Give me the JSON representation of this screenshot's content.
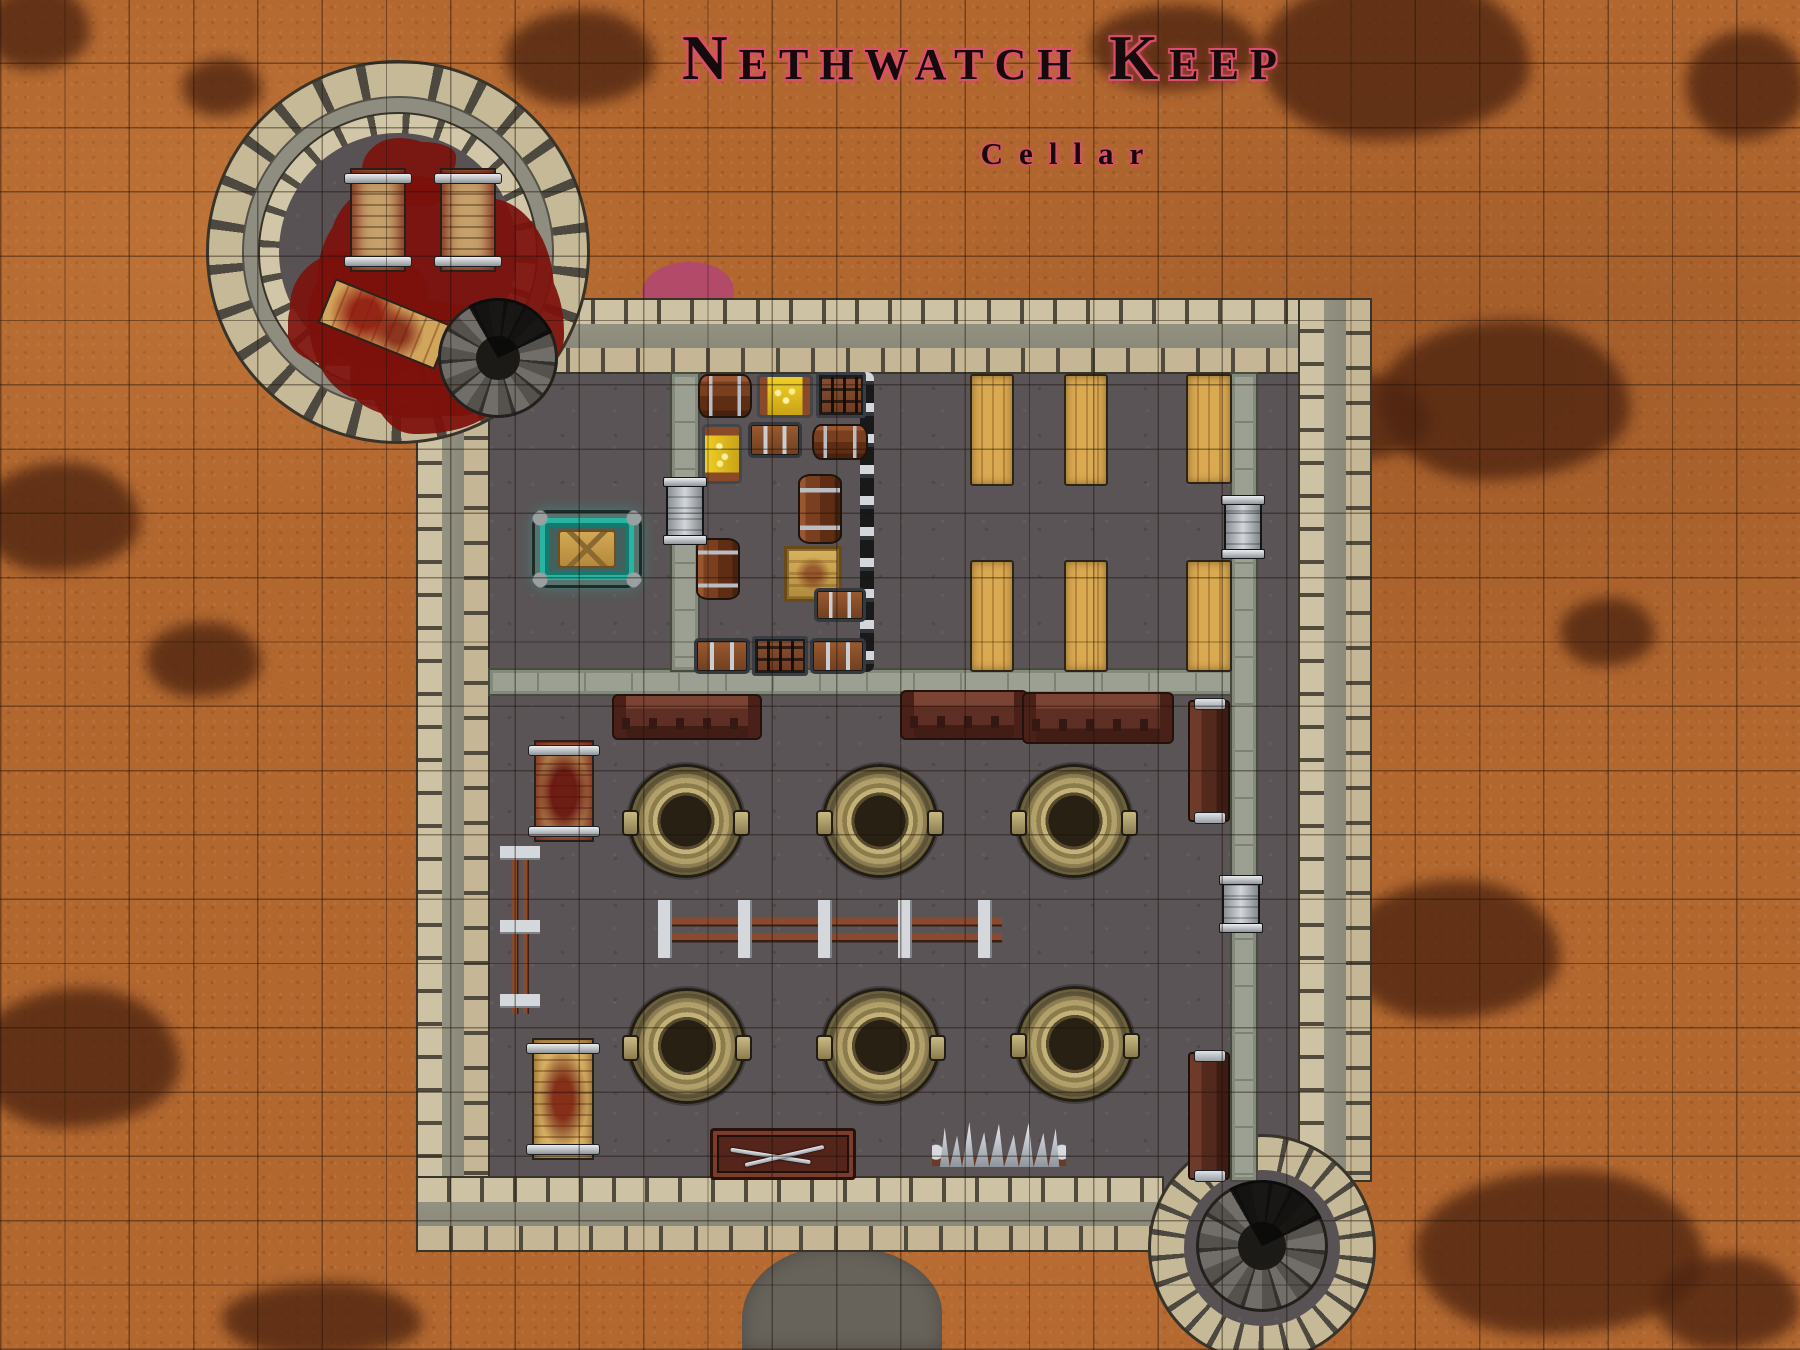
{
  "title": {
    "text": "Nethwatch Keep",
    "subtitle": "Cellar"
  },
  "colors": {
    "title_fill": "#150a0c",
    "title_glow": "#d94f66",
    "terrain": "#b2672f",
    "terrain_stain": "#4e2410",
    "floor": "#5a5456",
    "wall_stone": "#cec2a4",
    "wall_core": "#8f8d82",
    "blood": "#7d110c",
    "cauldron_brass": "#b3a26c",
    "gold": "#eecf2a",
    "ritual_teal": "#29b3a2",
    "table_wood": "#c89449",
    "bench_wood": "#5f2f24",
    "pink_marker": "#b4486e"
  },
  "grid": {
    "cell_px": 64.3
  },
  "map": {
    "objects": [
      {
        "n": "terrain-stain",
        "t": "stain",
        "x": 1090,
        "y": 5,
        "w": 170,
        "h": 85
      },
      {
        "n": "terrain-stain",
        "t": "stain",
        "x": 1260,
        "y": -25,
        "w": 270,
        "h": 165
      },
      {
        "n": "terrain-stain",
        "t": "stain",
        "x": 1686,
        "y": 30,
        "w": 120,
        "h": 110
      },
      {
        "n": "terrain-stain",
        "t": "stain",
        "x": 1380,
        "y": 320,
        "w": 250,
        "h": 160
      },
      {
        "n": "terrain-stain",
        "t": "stain",
        "x": 1290,
        "y": 375,
        "w": 140,
        "h": 85
      },
      {
        "n": "terrain-stain",
        "t": "stain",
        "x": 1560,
        "y": 598,
        "w": 95,
        "h": 68
      },
      {
        "n": "terrain-stain",
        "t": "stain",
        "x": 1345,
        "y": 880,
        "w": 215,
        "h": 140
      },
      {
        "n": "terrain-stain",
        "t": "stain",
        "x": 1415,
        "y": 1170,
        "w": 290,
        "h": 165
      },
      {
        "n": "terrain-stain",
        "t": "stain",
        "x": 1655,
        "y": 1255,
        "w": 145,
        "h": 95
      },
      {
        "n": "terrain-stain",
        "t": "stain",
        "x": -15,
        "y": -15,
        "w": 105,
        "h": 85
      },
      {
        "n": "terrain-stain",
        "t": "stain",
        "x": 182,
        "y": 58,
        "w": 80,
        "h": 58
      },
      {
        "n": "terrain-stain",
        "t": "stain",
        "x": -20,
        "y": 462,
        "w": 160,
        "h": 110
      },
      {
        "n": "terrain-stain",
        "t": "stain",
        "x": 146,
        "y": 622,
        "w": 115,
        "h": 75
      },
      {
        "n": "terrain-stain",
        "t": "stain",
        "x": -25,
        "y": 988,
        "w": 205,
        "h": 140
      },
      {
        "n": "terrain-stain",
        "t": "stain",
        "x": 222,
        "y": 1282,
        "w": 200,
        "h": 75
      },
      {
        "n": "terrain-stain",
        "t": "stain",
        "x": 505,
        "y": 10,
        "w": 150,
        "h": 95
      },
      {
        "n": "stone-path",
        "t": "grey-patch",
        "x": 742,
        "y": 1246,
        "w": 200,
        "h": 104
      },
      {
        "n": "pink-marker",
        "t": "pink-blob",
        "x": 642,
        "y": 262,
        "w": 92,
        "h": 52
      },
      {
        "n": "keep-floor",
        "t": "floor-keep",
        "x": 430,
        "y": 318,
        "w": 902,
        "h": 904
      },
      {
        "n": "wall-north",
        "t": "wall-h",
        "x": 428,
        "y": 298,
        "w": 934,
        "h": 76
      },
      {
        "n": "wall-west",
        "t": "wall-v",
        "x": 416,
        "y": 298,
        "w": 74,
        "h": 954
      },
      {
        "n": "wall-east",
        "t": "wall-v",
        "x": 1298,
        "y": 298,
        "w": 74,
        "h": 884
      },
      {
        "n": "wall-south",
        "t": "wall-h",
        "x": 416,
        "y": 1176,
        "w": 748,
        "h": 76
      },
      {
        "n": "stair-alcove-wall",
        "t": "disc-stone",
        "x": 1148,
        "y": 1134,
        "w": 228,
        "h": 228
      },
      {
        "n": "stair-alcove-floor",
        "t": "disc-floor",
        "x": 1184,
        "y": 1170,
        "w": 156,
        "h": 156
      },
      {
        "n": "tower-wall-outer",
        "t": "disc-stone",
        "x": 206,
        "y": 60,
        "w": 384,
        "h": 384
      },
      {
        "n": "tower-wall-band",
        "t": "disc-grey",
        "x": 242,
        "y": 96,
        "w": 312,
        "h": 312
      },
      {
        "n": "tower-wall-inner",
        "t": "disc-stone2",
        "x": 258,
        "y": 112,
        "w": 280,
        "h": 280
      },
      {
        "n": "tower-floor",
        "t": "disc-floor",
        "x": 279,
        "y": 133,
        "w": 238,
        "h": 238
      },
      {
        "n": "wall-divider",
        "t": "wall-thin-h",
        "x": 488,
        "y": 668,
        "w": 770,
        "h": 28
      },
      {
        "n": "wall-storage-west",
        "t": "wall-thin-v",
        "x": 670,
        "y": 372,
        "w": 30,
        "h": 300
      },
      {
        "n": "wall-inner-east",
        "t": "wall-thin-v",
        "x": 1230,
        "y": 372,
        "w": 28,
        "h": 810
      },
      {
        "n": "cell-bars",
        "t": "bars-v",
        "x": 860,
        "y": 372,
        "w": 14,
        "h": 300
      },
      {
        "n": "blood-pool",
        "t": "blood",
        "x": 318,
        "y": 182,
        "w": 200,
        "h": 198
      },
      {
        "n": "blood-splash",
        "t": "blood-spot",
        "x": 362,
        "y": 138,
        "w": 80,
        "h": 64
      },
      {
        "n": "blood-splash",
        "t": "blood-spot",
        "x": 290,
        "y": 252,
        "w": 124,
        "h": 108
      },
      {
        "n": "blood-splash",
        "t": "blood-spot",
        "x": 352,
        "y": 300,
        "w": 150,
        "h": 112
      },
      {
        "n": "torture-rack",
        "t": "rack",
        "x": 350,
        "y": 168,
        "w": 56,
        "h": 104
      },
      {
        "n": "torture-rack",
        "t": "rack",
        "x": 440,
        "y": 168,
        "w": 56,
        "h": 104
      },
      {
        "n": "bloody-table",
        "t": "table-blood",
        "x": 322,
        "y": 300,
        "w": 126,
        "h": 48,
        "r": 22
      },
      {
        "n": "spiral-stairs",
        "t": "spiral",
        "x": 438,
        "y": 298,
        "w": 120,
        "h": 120
      },
      {
        "n": "ritual-table",
        "t": "ritual-table",
        "x": 532,
        "y": 510,
        "w": 110,
        "h": 78
      },
      {
        "n": "barrel",
        "t": "barrel-h",
        "x": 698,
        "y": 374,
        "w": 54,
        "h": 44
      },
      {
        "n": "treasure-chest-open",
        "t": "chest-gold",
        "x": 757,
        "y": 374,
        "w": 56,
        "h": 44
      },
      {
        "n": "cage-crate",
        "t": "crate-cage",
        "x": 816,
        "y": 372,
        "w": 50,
        "h": 46
      },
      {
        "n": "treasure-chest-open",
        "t": "chest-gold-v",
        "x": 702,
        "y": 424,
        "w": 40,
        "h": 60
      },
      {
        "n": "chest",
        "t": "chest",
        "x": 748,
        "y": 422,
        "w": 54,
        "h": 36
      },
      {
        "n": "barrel",
        "t": "barrel-h",
        "x": 812,
        "y": 424,
        "w": 56,
        "h": 36
      },
      {
        "n": "barrel",
        "t": "barrel-v",
        "x": 798,
        "y": 474,
        "w": 44,
        "h": 70
      },
      {
        "n": "gold-crate",
        "t": "crate-gold",
        "x": 784,
        "y": 546,
        "w": 58,
        "h": 56
      },
      {
        "n": "barrel",
        "t": "barrel-v",
        "x": 696,
        "y": 538,
        "w": 44,
        "h": 62
      },
      {
        "n": "chest",
        "t": "chest",
        "x": 814,
        "y": 588,
        "w": 52,
        "h": 34
      },
      {
        "n": "chest",
        "t": "chest",
        "x": 694,
        "y": 638,
        "w": 56,
        "h": 36
      },
      {
        "n": "cage-crate",
        "t": "crate-cage",
        "x": 752,
        "y": 636,
        "w": 56,
        "h": 40
      },
      {
        "n": "chest",
        "t": "chest",
        "x": 810,
        "y": 638,
        "w": 56,
        "h": 36
      },
      {
        "n": "wooden-table",
        "t": "table-wood",
        "x": 970,
        "y": 374,
        "w": 44,
        "h": 112
      },
      {
        "n": "wooden-table",
        "t": "table-wood",
        "x": 1064,
        "y": 374,
        "w": 44,
        "h": 112
      },
      {
        "n": "wooden-table",
        "t": "table-wood",
        "x": 1186,
        "y": 374,
        "w": 46,
        "h": 110
      },
      {
        "n": "wooden-table",
        "t": "table-wood",
        "x": 970,
        "y": 560,
        "w": 44,
        "h": 112
      },
      {
        "n": "wooden-table",
        "t": "table-wood",
        "x": 1064,
        "y": 560,
        "w": 44,
        "h": 112
      },
      {
        "n": "wooden-table",
        "t": "table-wood",
        "x": 1186,
        "y": 560,
        "w": 46,
        "h": 112
      },
      {
        "n": "ornate-bench",
        "t": "bench-ornate",
        "x": 612,
        "y": 694,
        "w": 150,
        "h": 46
      },
      {
        "n": "ornate-bench",
        "t": "bench-ornate",
        "x": 900,
        "y": 690,
        "w": 128,
        "h": 50
      },
      {
        "n": "ornate-bench",
        "t": "bench-ornate",
        "x": 1022,
        "y": 692,
        "w": 152,
        "h": 52
      },
      {
        "n": "torture-rack-bloody",
        "t": "rack-blood",
        "x": 534,
        "y": 740,
        "w": 60,
        "h": 102
      },
      {
        "n": "cauldron",
        "t": "cauldron",
        "x": 628,
        "y": 764,
        "w": 116,
        "h": 114
      },
      {
        "n": "cauldron",
        "t": "cauldron",
        "x": 822,
        "y": 764,
        "w": 116,
        "h": 114
      },
      {
        "n": "cauldron",
        "t": "cauldron",
        "x": 1016,
        "y": 764,
        "w": 116,
        "h": 114
      },
      {
        "n": "rail-fence",
        "t": "rail-v",
        "x": 500,
        "y": 846,
        "w": 40,
        "h": 168
      },
      {
        "n": "rail-fence",
        "t": "rail-h",
        "x": 658,
        "y": 900,
        "w": 344,
        "h": 58
      },
      {
        "n": "cauldron",
        "t": "cauldron",
        "x": 628,
        "y": 988,
        "w": 118,
        "h": 116
      },
      {
        "n": "cauldron",
        "t": "cauldron",
        "x": 822,
        "y": 988,
        "w": 118,
        "h": 116
      },
      {
        "n": "cauldron",
        "t": "cauldron",
        "x": 1016,
        "y": 986,
        "w": 118,
        "h": 116
      },
      {
        "n": "torture-rack-gold",
        "t": "rack-gold",
        "x": 532,
        "y": 1038,
        "w": 62,
        "h": 122
      },
      {
        "n": "weapon-rack-chest",
        "t": "weapon-chest",
        "x": 710,
        "y": 1128,
        "w": 146,
        "h": 52
      },
      {
        "n": "spike-row",
        "t": "spikes",
        "x": 932,
        "y": 1122,
        "w": 134,
        "h": 58
      },
      {
        "n": "bench",
        "t": "bench-v",
        "x": 1188,
        "y": 700,
        "w": 42,
        "h": 122
      },
      {
        "n": "bench",
        "t": "bench-v",
        "x": 1188,
        "y": 1052,
        "w": 42,
        "h": 128
      },
      {
        "n": "door",
        "t": "door-v",
        "x": 666,
        "y": 478,
        "w": 38,
        "h": 66
      },
      {
        "n": "door",
        "t": "door-v",
        "x": 1224,
        "y": 496,
        "w": 38,
        "h": 62
      },
      {
        "n": "door",
        "t": "door-v",
        "x": 1222,
        "y": 876,
        "w": 38,
        "h": 56
      },
      {
        "n": "spiral-stairs",
        "t": "spiral",
        "x": 1196,
        "y": 1180,
        "w": 132,
        "h": 132
      }
    ]
  }
}
